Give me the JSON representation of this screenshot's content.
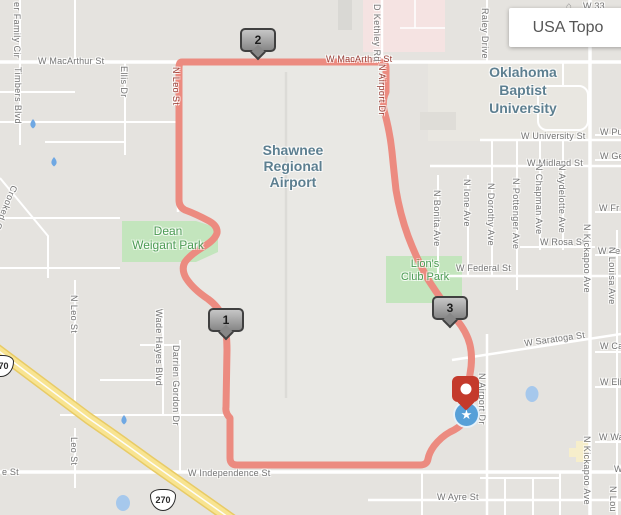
{
  "controls": {
    "layer_button": "USA Topo"
  },
  "icons": {
    "star": "★",
    "home": "⌂"
  },
  "colors": {
    "map_background": "#e5e3df",
    "route": "#ec8b80",
    "route_label_text": "#9a4038",
    "park_fill": "#c3e5bd",
    "park_text": "#4d9b55",
    "place_text": "#5d7f90",
    "highway_yellow": "#f8e491",
    "water_blue": "#6fa8e3",
    "end_pin_red": "#c43a2c",
    "start_circle_blue": "#57a0d8",
    "hospital_pink": "#f5e3e2"
  },
  "places": {
    "airport": "Shawnee\nRegional\nAirport",
    "university": "Oklahoma\nBaptist\nUniversity",
    "park_dean": "Dean\nWeigant Park",
    "park_lions": "Lion's\nClub Park"
  },
  "route_markers": {
    "m1": "1",
    "m2": "2",
    "m3": "3"
  },
  "shields": {
    "us270": "270"
  },
  "streets": [
    "W MacArthur St",
    "W MacArthur St",
    "W University St",
    "W Midland St",
    "W Rosa St",
    "W Federal St",
    "W Saratoga St",
    "W Independence St",
    "W Ayre St",
    "W 33",
    "W Pu",
    "W Ge",
    "W Fr",
    "W Fe",
    "W Ca",
    "W Eli",
    "W Wa",
    "W",
    "e St",
    "er Family Cir",
    "Timbers Blvd",
    "Crooked Oak Ct",
    "Ellis Dr",
    "N Leo St",
    "D Kethley Rd",
    "N Airport Dr",
    "Raley Drive",
    "N Bonita Ave",
    "N Ione Ave",
    "N Dorothy Ave",
    "N Pottenger Ave",
    "N Chapman Ave",
    "N Aydelotte Ave",
    "N Kickapoo Ave",
    "N Louisa Ave",
    "N Leo St",
    "Wade Hayes Blvd",
    "Darrien Gordon Dr",
    "Leo St",
    "N Airport Dr",
    "N Kickapoo Ave",
    "N Lou"
  ]
}
